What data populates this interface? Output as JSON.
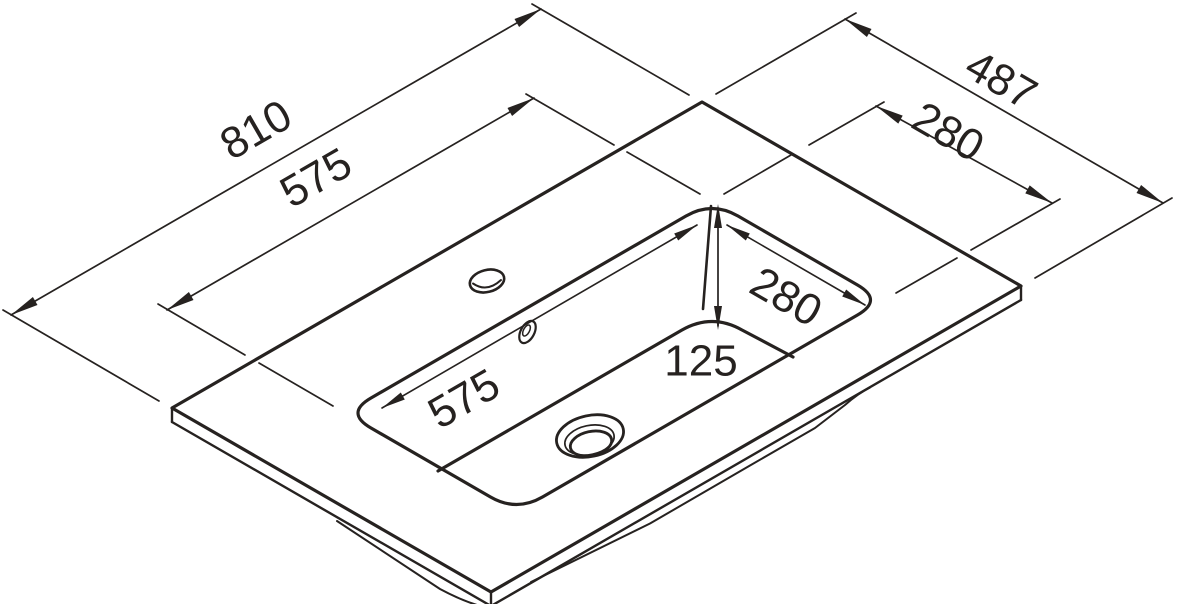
{
  "drawing": {
    "type": "isometric-technical-drawing",
    "subject": "washbasin-vanity-top",
    "colors": {
      "ink": "#262220",
      "background": "#ffffff"
    },
    "dimensions": {
      "slab_length": "810",
      "basin_length_top": "575",
      "slab_depth": "487",
      "basin_width_top": "280",
      "basin_width_inner": "280",
      "basin_length_inner": "575",
      "basin_depth": "125"
    }
  }
}
